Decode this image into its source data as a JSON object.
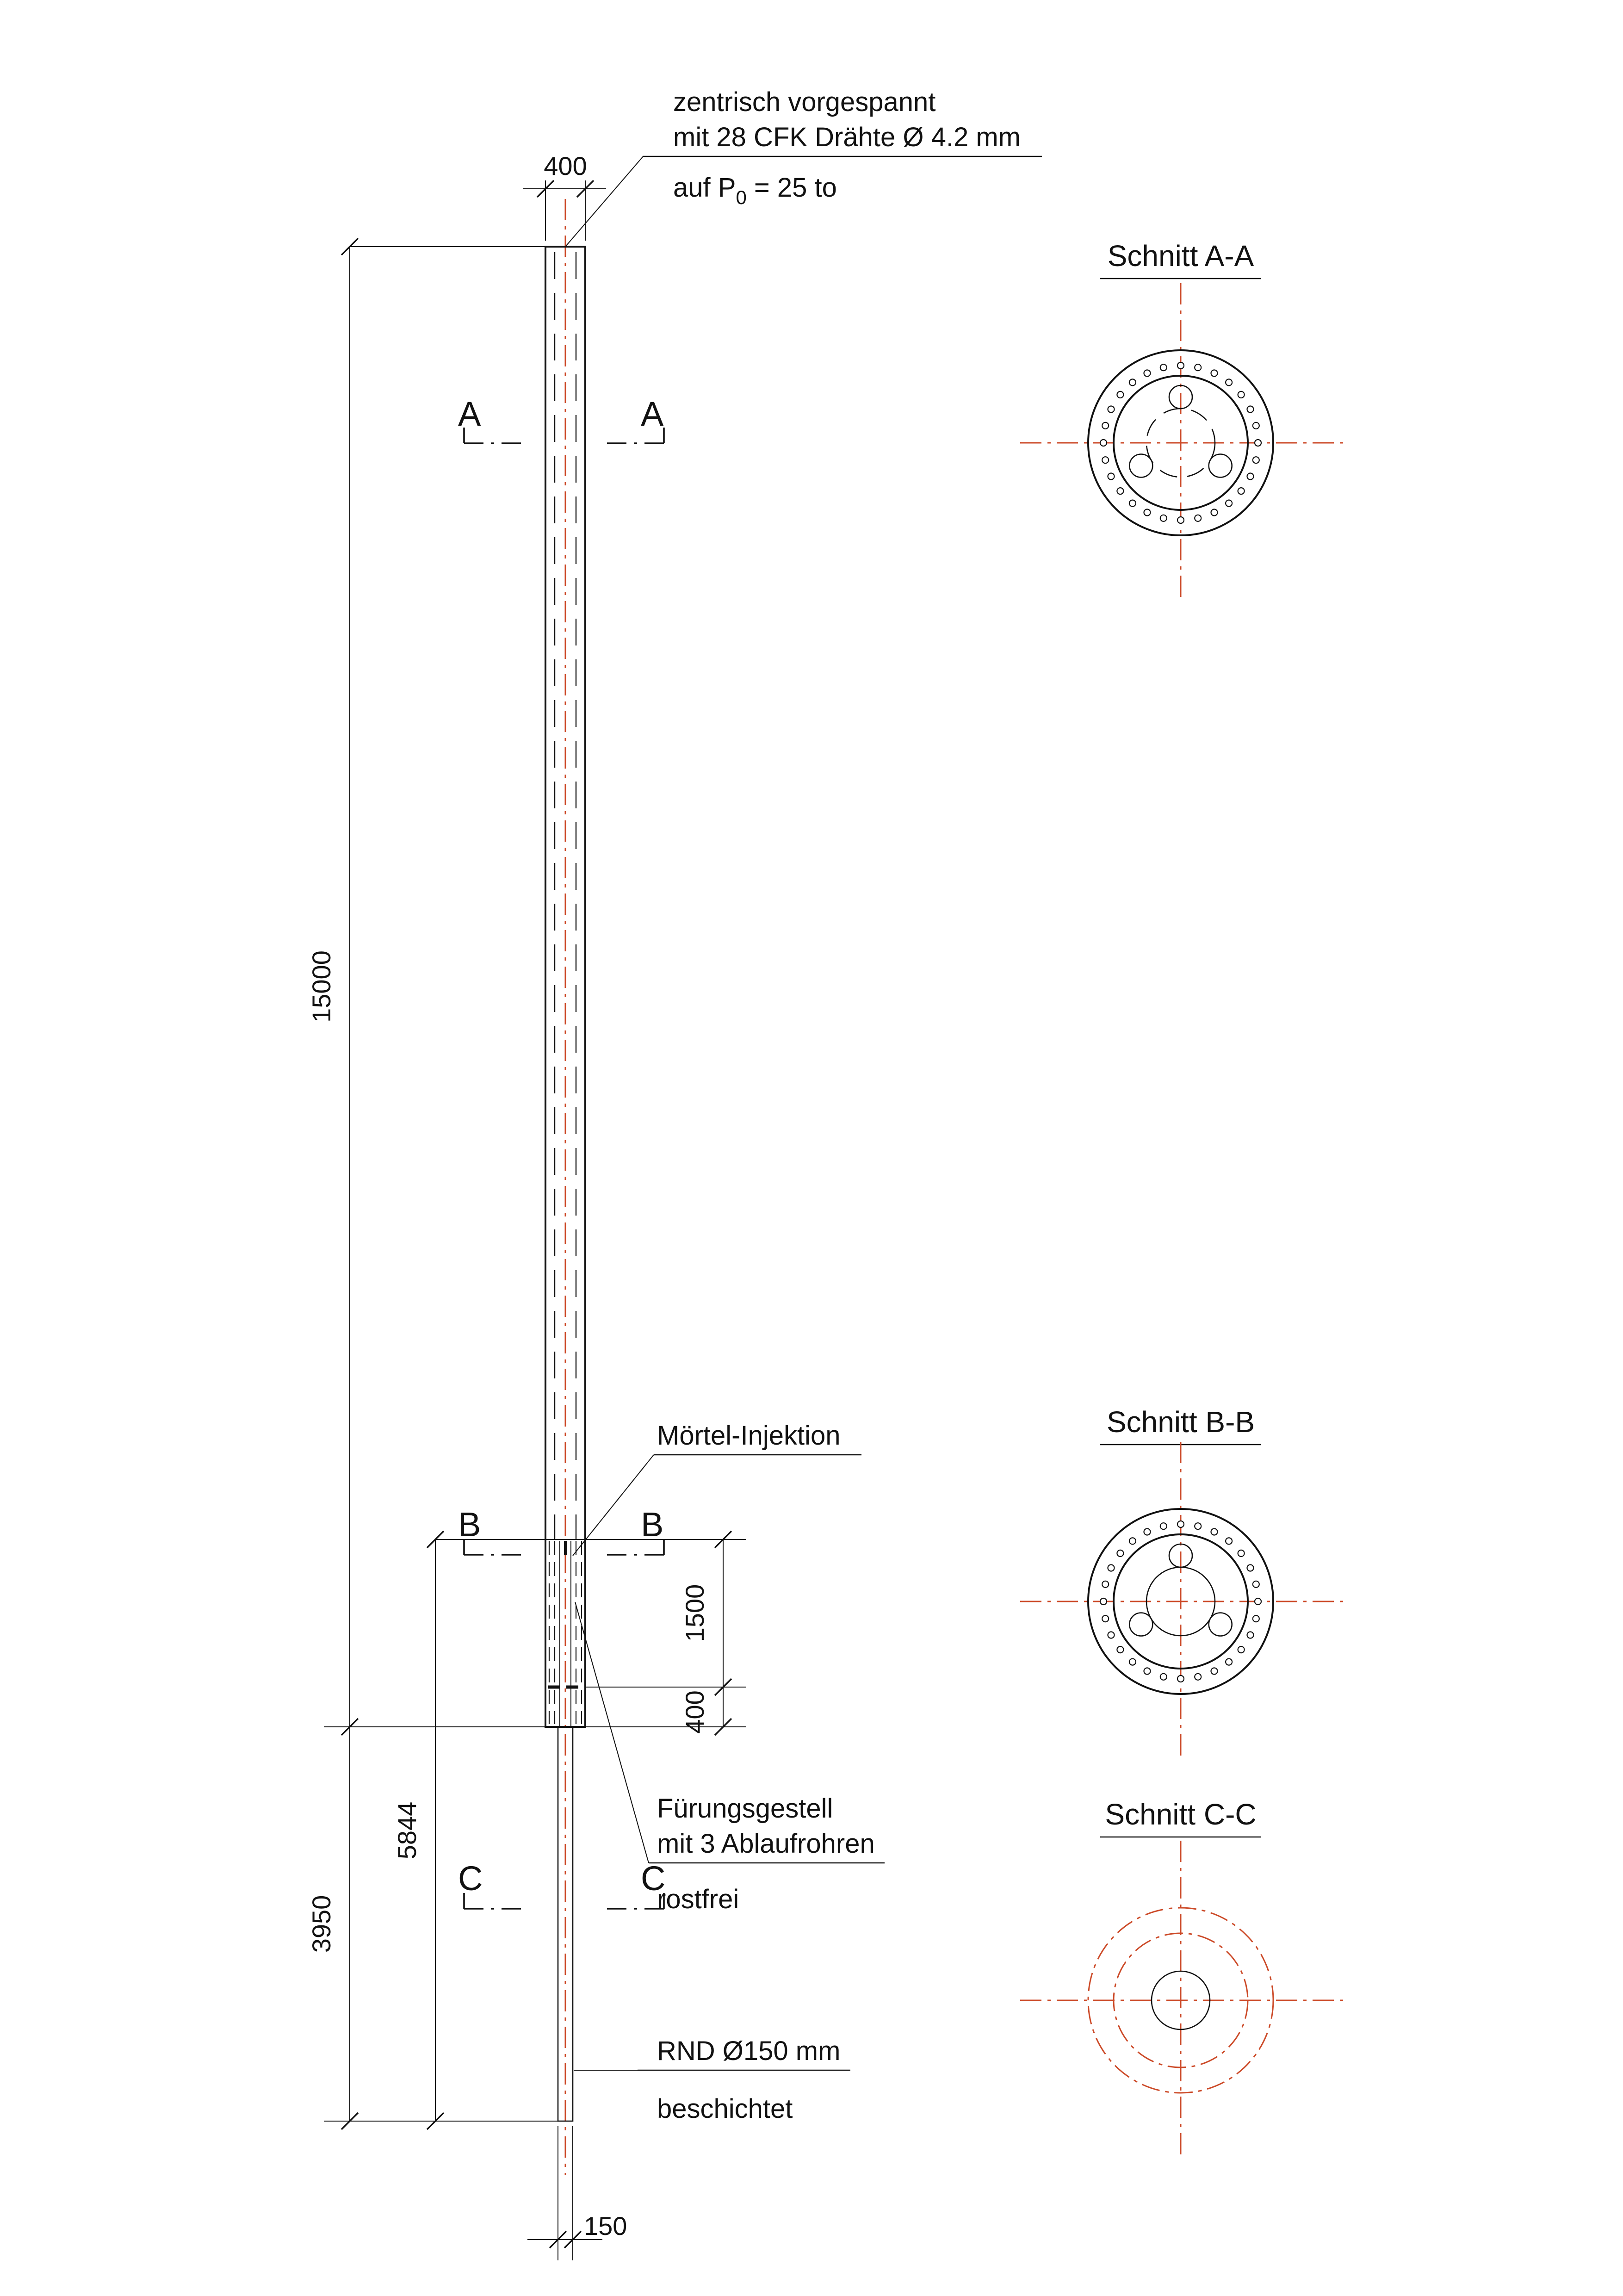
{
  "drawing": {
    "annotations": {
      "prestress": {
        "line1": "zentrisch vorgespannt",
        "line2": "mit 28 CFK Drähte Ø 4.2 mm",
        "line3_prefix": "auf P",
        "line3_sub": "0",
        "line3_suffix": " = 25 to"
      },
      "mortar": {
        "label": "Mörtel-Injektion"
      },
      "guide": {
        "line1": "Fürungsgestell",
        "line2": "mit 3 Ablaufrohren",
        "line3": "rostfrei"
      },
      "rod": {
        "line1": "RND Ø150 mm",
        "line2": "beschichtet"
      }
    },
    "dimensions": {
      "top_width": "400",
      "pole_length": "15000",
      "guide_upper": "1500",
      "guide_lower": "400",
      "lower_total": "5844",
      "rod_exposed": "3950",
      "rod_width": "150"
    },
    "section_markers": {
      "a": "A",
      "b": "B",
      "c": "C"
    },
    "sections": {
      "a_title": "Schnitt A-A",
      "b_title": "Schnitt B-B",
      "c_title": "Schnitt C-C",
      "wire_count": 28
    },
    "colors": {
      "centerline": "#cc4a28",
      "line": "#111111"
    }
  }
}
